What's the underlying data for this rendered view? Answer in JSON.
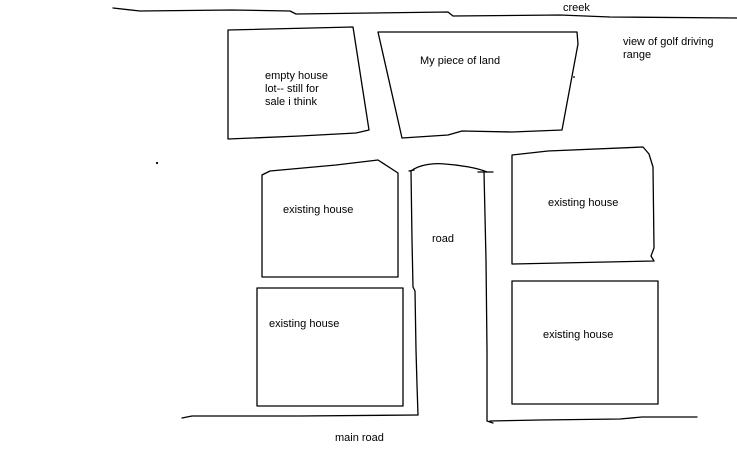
{
  "drawing": {
    "type": "hand-drawn-property-sketch",
    "background_color": "#ffffff",
    "line_color": "#000000"
  },
  "labels": {
    "creek": "creek",
    "golf_view": {
      "line1": "view of golf driving",
      "line2": "range"
    },
    "my_land": "My piece of land",
    "empty_lot": {
      "line1": "empty house",
      "line2": "lot-- still for",
      "line3": "sale i think"
    },
    "existing_house_upper_left": "existing house",
    "existing_house_upper_right": "existing house",
    "existing_house_lower_left": "existing house",
    "existing_house_lower_right": "existing house",
    "road": "road",
    "main_road": "main road"
  }
}
